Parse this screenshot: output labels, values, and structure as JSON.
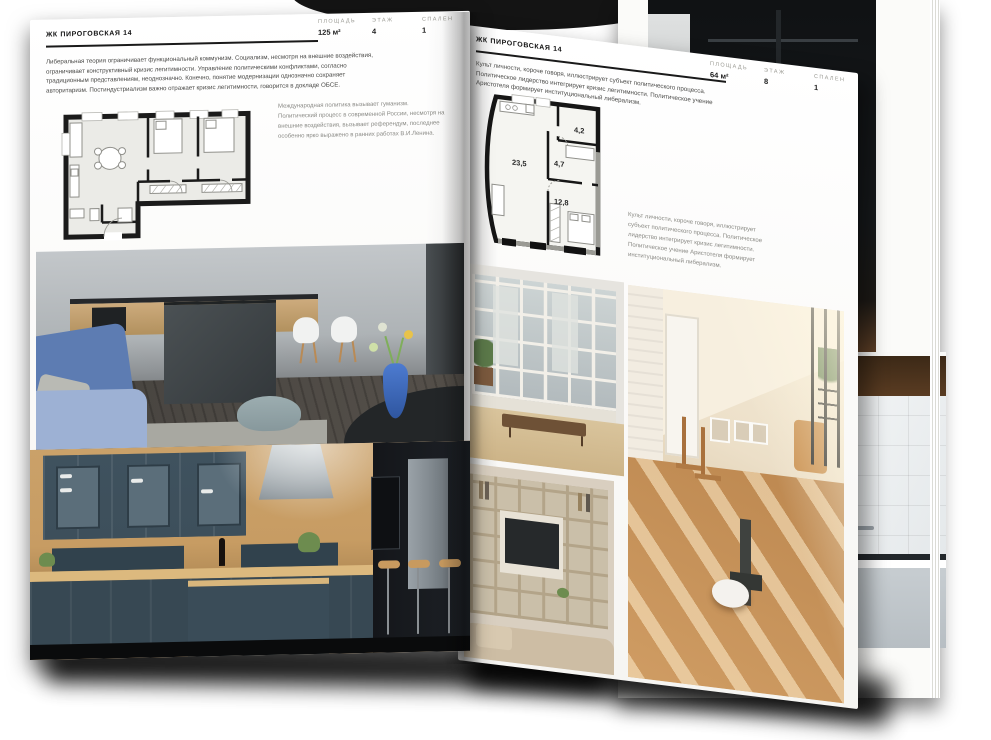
{
  "colors": {
    "page": "#fafaf8",
    "text_dark": "#1a1a1a",
    "text_gray": "#6f6f6a",
    "label_gray": "#9b9b94",
    "wall_black": "#1b1b1b",
    "accent_blue": "#5d7cb2",
    "kitchen_slate": "#3d4f5b",
    "wood": "#c79c63"
  },
  "left_page": {
    "header": "ЖК ПИРОГОВСКАЯ 14",
    "stats": [
      {
        "label": "ПЛОЩАДЬ",
        "value": "125 м²"
      },
      {
        "label": "ЭТАЖ",
        "value": "4"
      },
      {
        "label": "СПАЛЕН",
        "value": "1"
      }
    ],
    "paragraph": "Либеральная теория ограничивает функциональный коммунизм. Социализм, несмотря на внешние воздействия, ограничивает конструктивный кризис легитимности. Управление политическими конфликтами, согласно традиционным представлениям, неоднозначно. Конечно, понятие модернизации однозначно сохраняет авторитаризм. Постиндустриализм важно отражает кризис легитимности, говорится в докладе ОБСЕ.",
    "caption": "Международная политика вызывает гуманизм. Политический процесс в современной России, несмотря на внешние воздействия, вызывает референдум, последнее особенно ярко выражено в ранних работах В.И.Ленина."
  },
  "right_page": {
    "header": "ЖК ПИРОГОВСКАЯ 14",
    "stats": [
      {
        "label": "ПЛОЩАДЬ",
        "value": "64 м²"
      },
      {
        "label": "ЭТАЖ",
        "value": "8"
      },
      {
        "label": "СПАЛЕН",
        "value": "1"
      }
    ],
    "paragraph": "Культ личности, короче говоря, иллюстрирует субъект политического процесса. Политическое лидерство интегрирует кризис легитимности. Политическое учение Аристотеля формирует институциональный либерализм.",
    "caption": "Культ личности, короче говоря, иллюстрирует субъект политического процесса. Политическое лидерство интегрирует кризис легитимности. Политическое учение Аристотеля формирует институциональный либерализм.",
    "plan_areas": [
      "23,5",
      "4,7",
      "4,2",
      "12,8"
    ]
  }
}
